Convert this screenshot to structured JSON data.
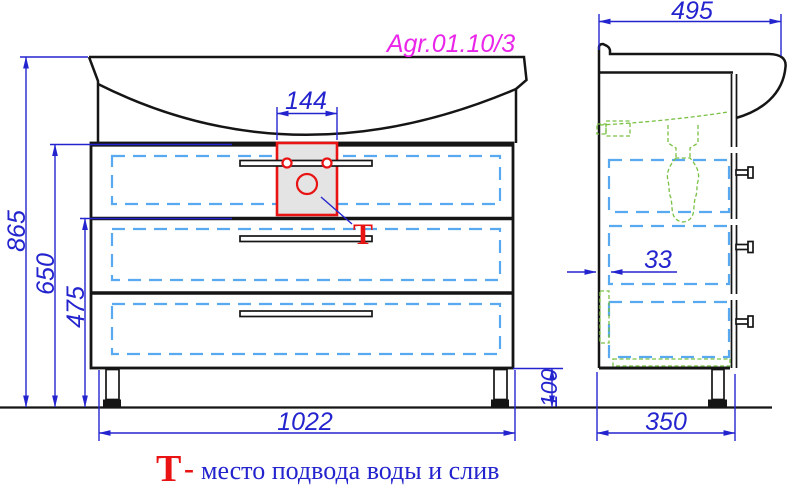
{
  "title": "Agr.01.10/3",
  "front_view": {
    "width": "1022",
    "total_height": "865",
    "worktop_height": "650",
    "drawer_stack_height": "475",
    "cutout_width": "144",
    "leg_height": "100",
    "callout_symbol": "T"
  },
  "side_view": {
    "depth": "495",
    "wall_gap": "33",
    "body_depth": "350"
  },
  "legend": {
    "symbol": "T",
    "separator": "-",
    "text": "место подвода воды и слив"
  },
  "colors": {
    "line_black": "#151515",
    "dimension_blue": "#2424cf",
    "drawer_dash_blue": "#58a9ef",
    "fitting_green": "#79c043",
    "accent_red": "#e91313",
    "title_magenta": "#ea25ea"
  }
}
